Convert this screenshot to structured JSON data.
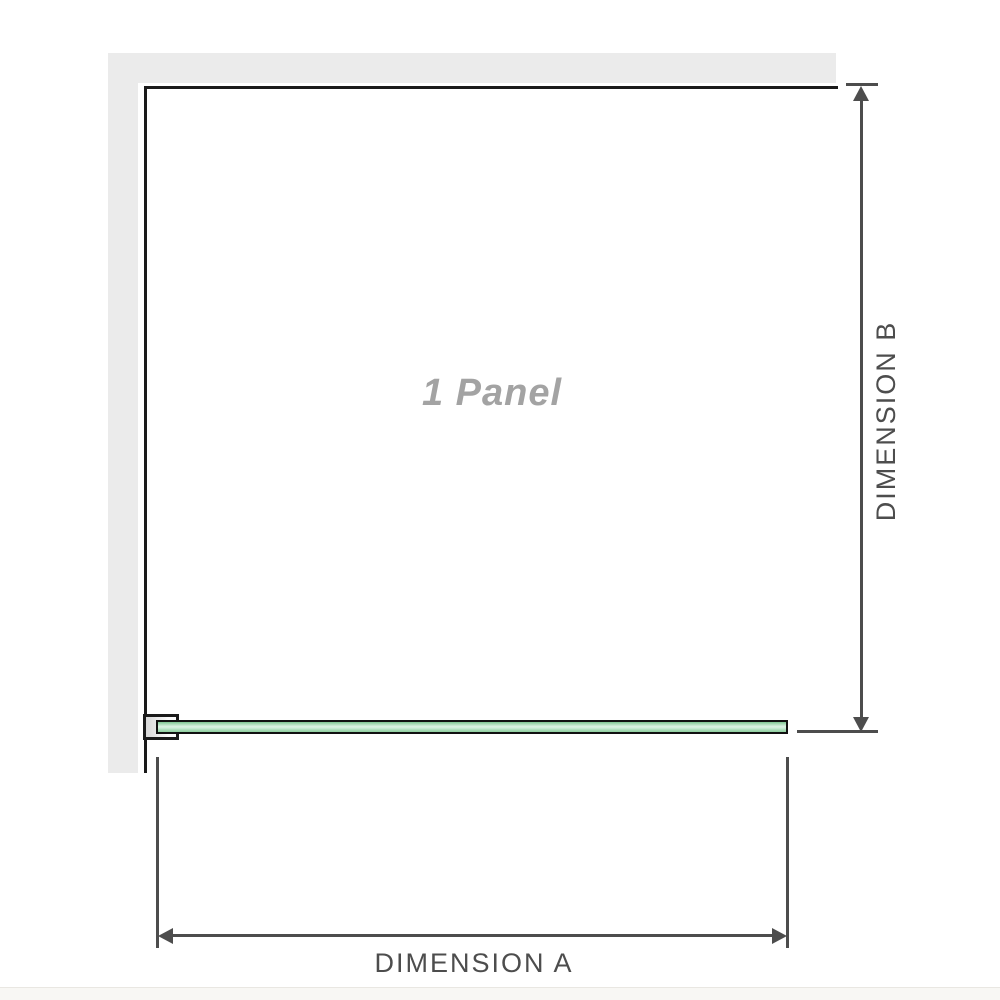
{
  "diagram": {
    "panel_label": "1 Panel",
    "dimension_a": "DIMENSION A",
    "dimension_b": "DIMENSION B"
  },
  "colors": {
    "wall": "#ebebeb",
    "outline": "#1a1a1a",
    "dimension": "#4d4d4d",
    "label": "#4d4d4d",
    "panel_text": "#a3a3a3",
    "glass_border": "#111111",
    "glass_light": "#ddf2e3",
    "glass_green": "#8fce9f"
  }
}
